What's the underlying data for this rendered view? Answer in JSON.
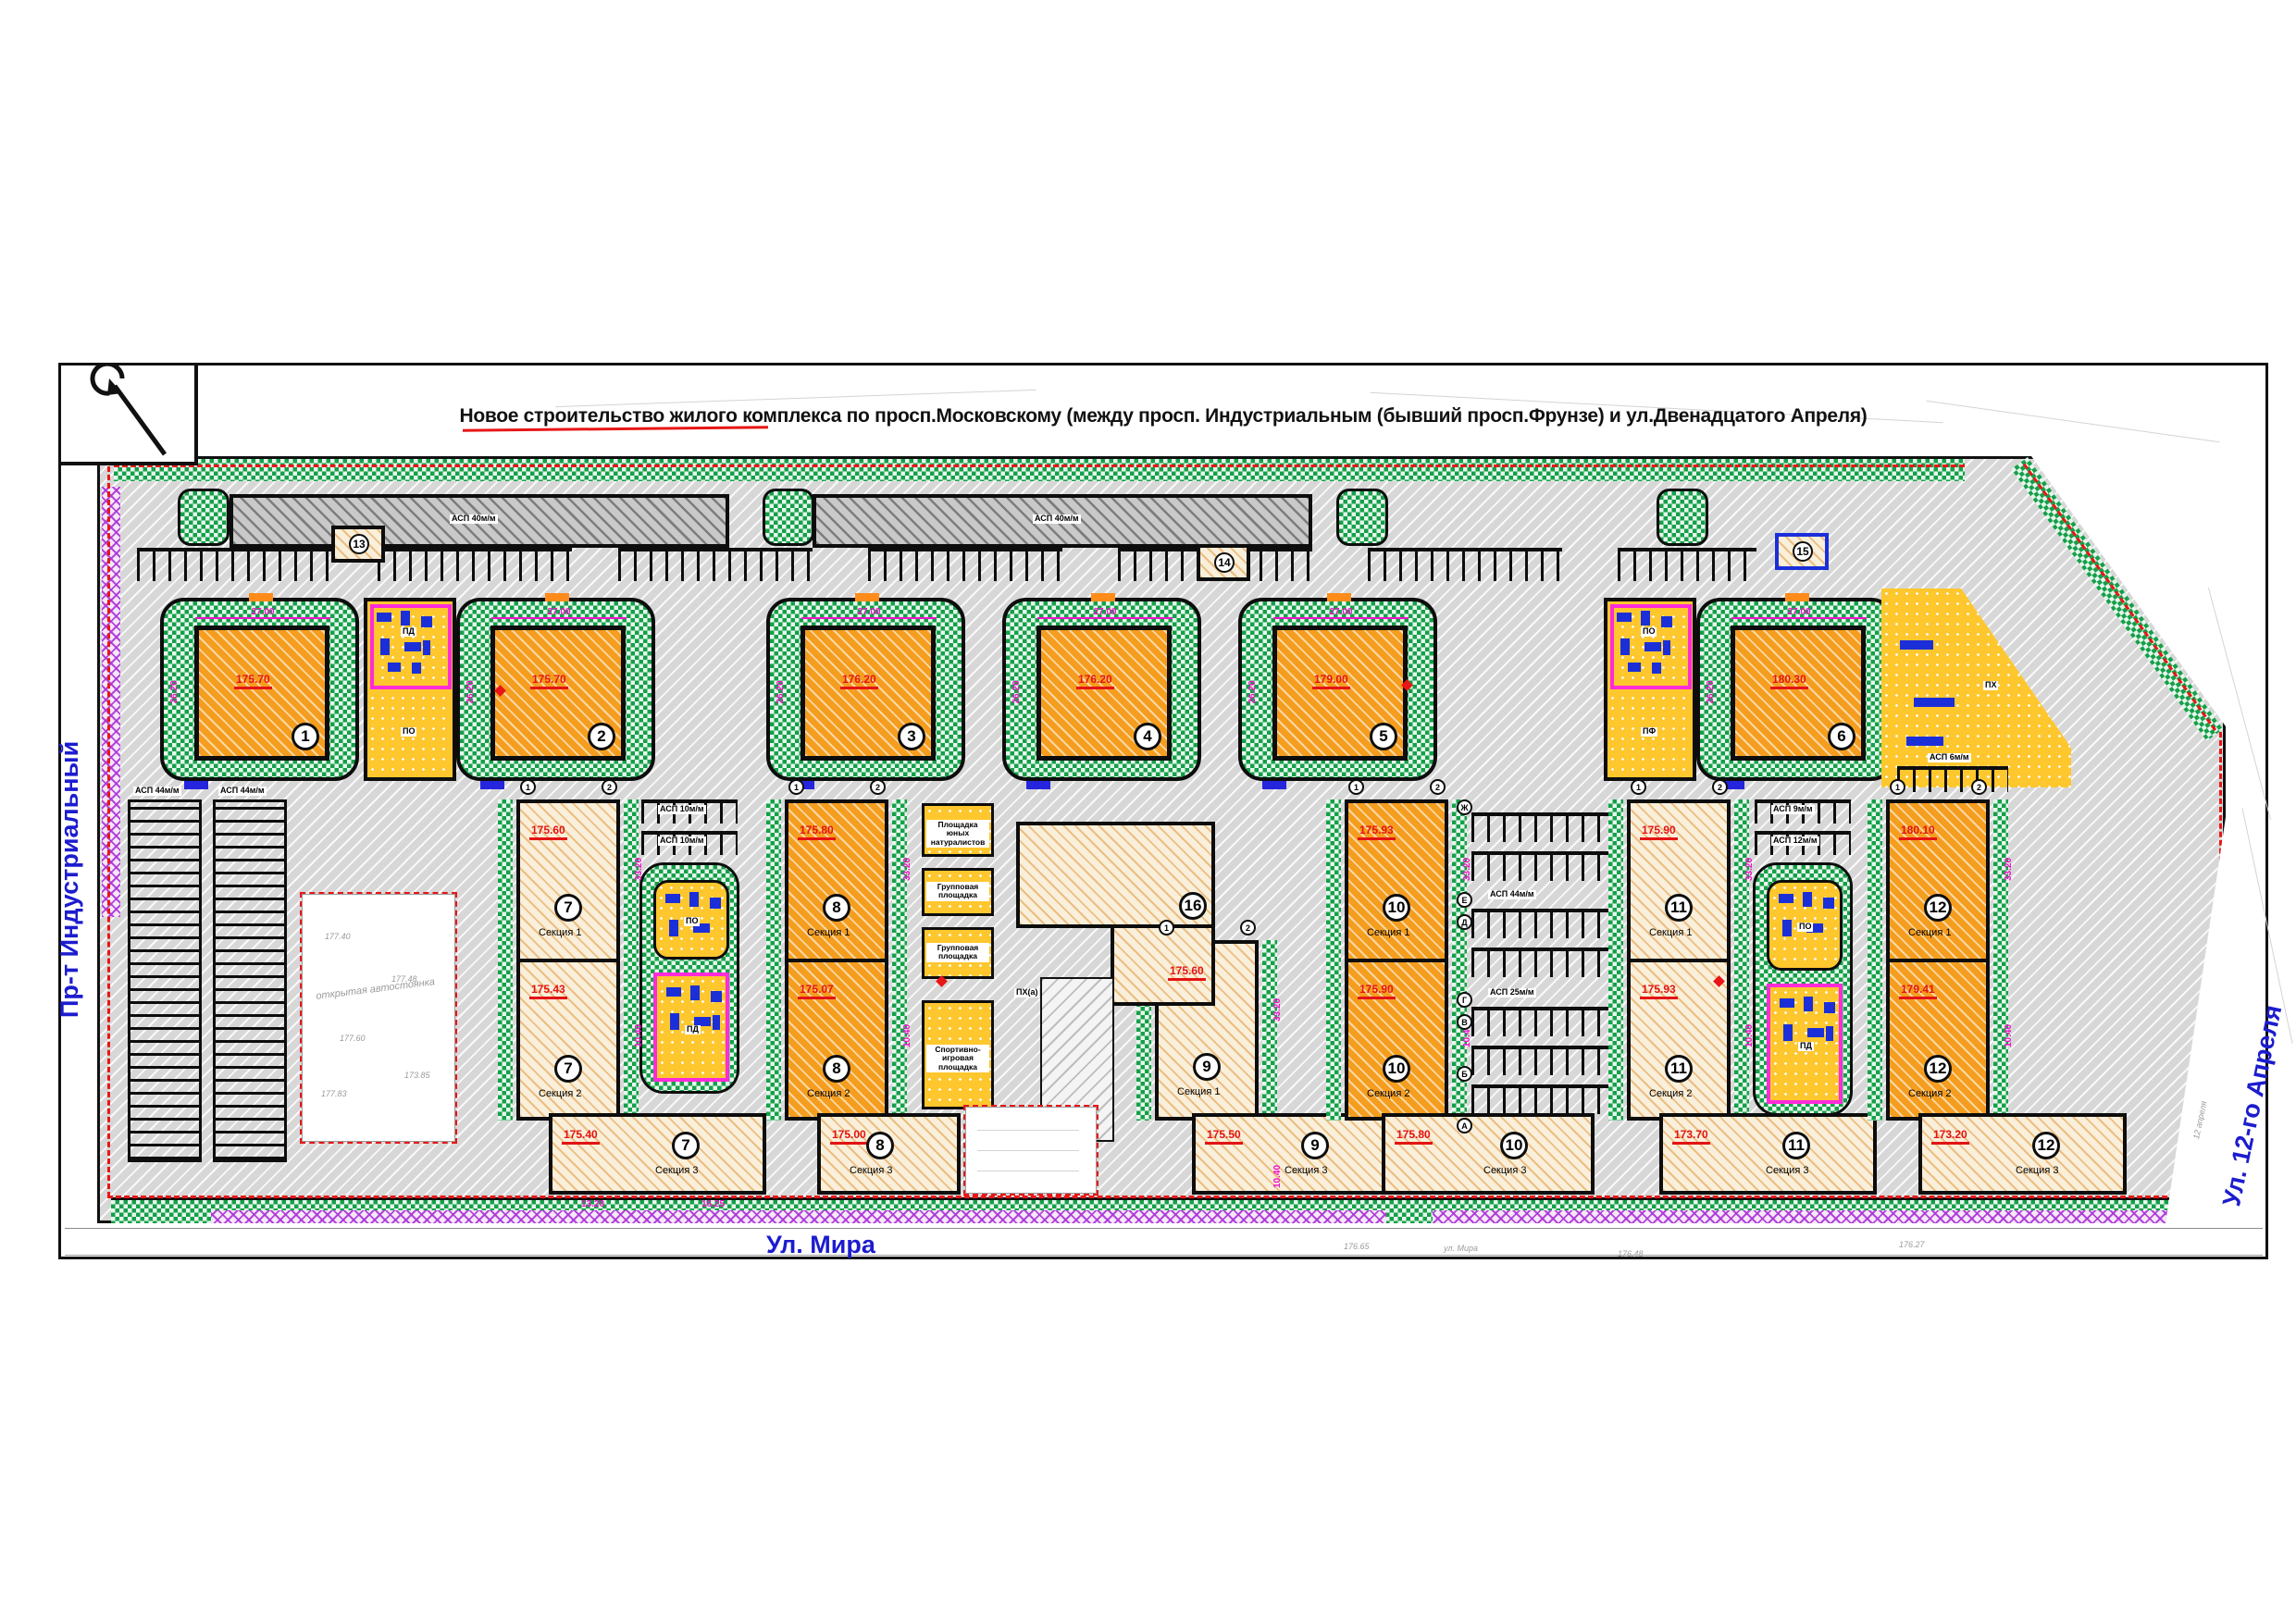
{
  "sheet": {
    "title": "Новое строительство жилого комплекса по просп.Московскому (между просп. Индустриальным (бывший просп.Фрунзе)   и ул.Двенадцатого Апреля)"
  },
  "streets": {
    "left": "Пр-т Индустриальный",
    "left_old": "Пр Фрунзе",
    "bottom": "Ул. Мира",
    "bottom_small": "ул. Мира",
    "right": "Ул. 12-го Апреля",
    "right_small": "12 апреля"
  },
  "towers": [
    {
      "num": "1",
      "elev": "175.70"
    },
    {
      "num": "2",
      "elev": "175.70"
    },
    {
      "num": "3",
      "elev": "176.20"
    },
    {
      "num": "4",
      "elev": "176.20"
    },
    {
      "num": "5",
      "elev": "179.00"
    },
    {
      "num": "6",
      "elev": "180.30"
    }
  ],
  "tp_units": [
    {
      "num": "13"
    },
    {
      "num": "14"
    },
    {
      "num": "15"
    }
  ],
  "kindergarten": {
    "num": "16"
  },
  "buildings": [
    {
      "num": "7",
      "style": "cream",
      "sections": [
        {
          "label": "Секция 1",
          "elev": "175.60"
        },
        {
          "label": "Секция 2",
          "elev": "175.43"
        },
        {
          "label": "Секция 3",
          "elev": "175.40"
        }
      ]
    },
    {
      "num": "8",
      "style": "orange",
      "sections": [
        {
          "label": "Секция 1",
          "elev": "175.80"
        },
        {
          "label": "Секция 2",
          "elev": "175.07"
        },
        {
          "label": "Секция 3",
          "elev": "175.00"
        }
      ]
    },
    {
      "num": "9",
      "style": "cream",
      "sections": [
        {
          "label": "Секция 1",
          "elev": "175.60"
        },
        {
          "label": "Секция 3",
          "elev": "175.50"
        }
      ]
    },
    {
      "num": "10",
      "style": "orange",
      "sections": [
        {
          "label": "Секция 1",
          "elev": "175.93"
        },
        {
          "label": "Секция 2",
          "elev": "175.90"
        },
        {
          "label": "Секция 3",
          "elev": "175.80"
        }
      ]
    },
    {
      "num": "11",
      "style": "cream",
      "sections": [
        {
          "label": "Секция 1",
          "elev": "175.90"
        },
        {
          "label": "Секция 2",
          "elev": "175.93"
        },
        {
          "label": "Секция 3",
          "elev": "173.70"
        }
      ]
    },
    {
      "num": "12",
      "style": "orange",
      "sections": [
        {
          "label": "Секция 1",
          "elev": "180.10"
        },
        {
          "label": "Секция 2",
          "elev": "179.41"
        },
        {
          "label": "Секция 3",
          "elev": "173.20"
        }
      ]
    }
  ],
  "named_playgrounds": [
    "Площадка юных натуралистов",
    "Групповая площадка",
    "Групповая площадка",
    "Спортивно-игровая площадка"
  ],
  "pg_chips": {
    "po": "ПО",
    "pd": "ПД",
    "pf": "ПФ",
    "ph": "ПХ",
    "pha": "ПХ(а)"
  },
  "parking_labels": {
    "top": "АСП 40м/м",
    "left": "АСП 44м/м",
    "p10": "АСП 10м/м",
    "p44": "АСП 44м/м",
    "p25": "АСП 25м/м",
    "p9": "АСП 9м/м",
    "p12": "АСП 12м/м",
    "p6": "АСП 6м/м"
  },
  "open_parking_label": "открытая автостоянка",
  "dims": {
    "tower_w": "27.00",
    "tower_h": "26.20",
    "len": "33.20",
    "gap": "10.40",
    "w1": "13.20",
    "w2": "16.25"
  },
  "axes": {
    "letters": [
      "Ж",
      "Е",
      "Д",
      "Г",
      "В",
      "Б",
      "А"
    ],
    "numbers": [
      "1",
      "2"
    ]
  },
  "survey_marks": [
    "177.40",
    "177.48",
    "177.60",
    "177.83",
    "173.85",
    "176.65",
    "176.48",
    "176.27"
  ],
  "colors": {
    "green": "#14a049",
    "paving": "#d7d7d7",
    "orange_building": "#f59d1e",
    "cream_building": "#f9efda",
    "playground_yellow": "#ffc72e",
    "magenta": "#ee13c8",
    "boundary_red": "#e81616",
    "street_blue": "#1c1ccf",
    "purple": "#ab35d6",
    "equipment_blue": "#1b2fd9"
  }
}
